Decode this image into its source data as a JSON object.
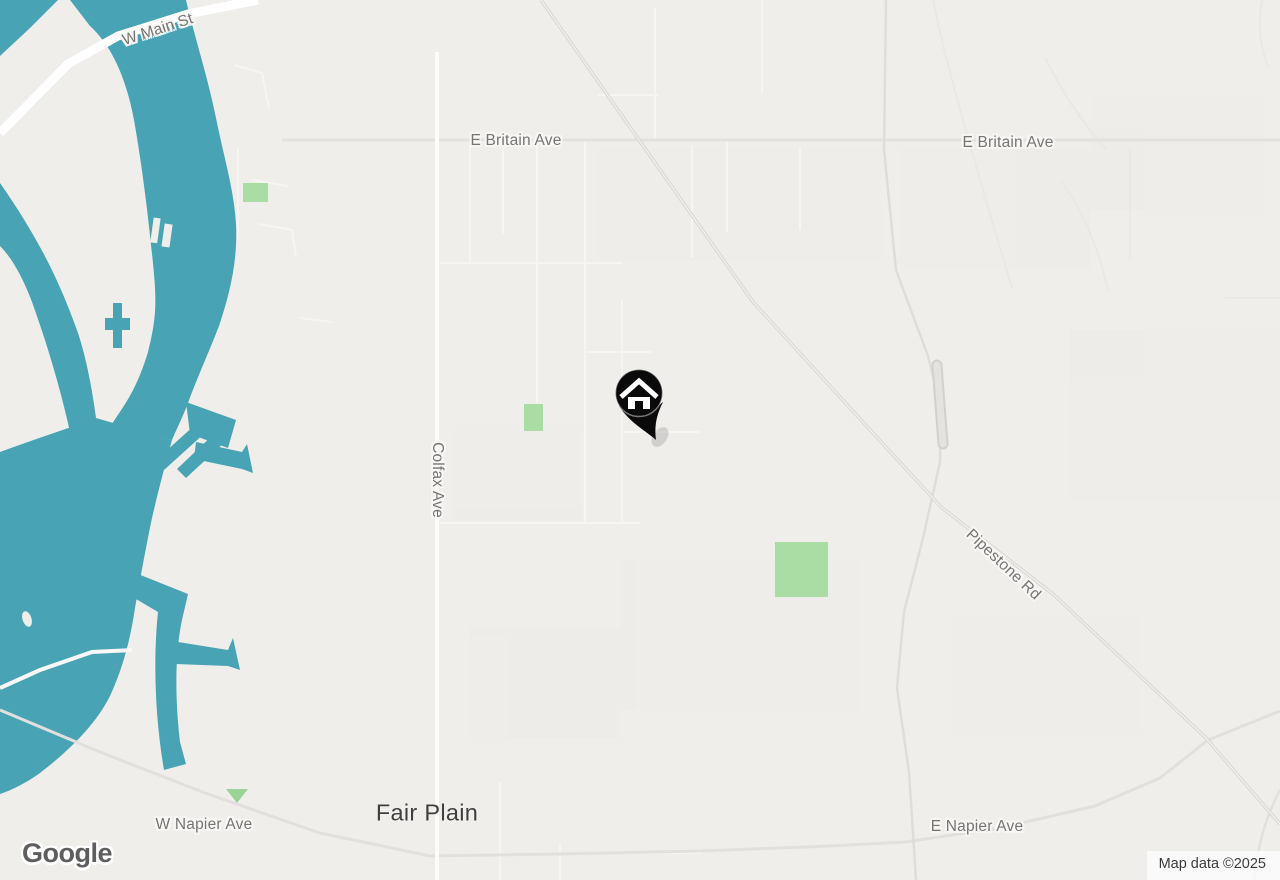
{
  "map": {
    "place_labels": {
      "fair_plain": "Fair Plain"
    },
    "street_labels": {
      "w_main_st": "W Main St",
      "e_britain_ave_west": "E Britain Ave",
      "e_britain_ave_east": "E Britain Ave",
      "colfax_ave": "Colfax Ave",
      "pipestone_rd": "Pipestone Rd",
      "w_napier_ave": "W Napier Ave",
      "e_napier_ave": "E Napier Ave"
    },
    "marker": {
      "type": "home-pin"
    },
    "attribution": {
      "logo": "Google",
      "copyright": "Map data ©2025"
    },
    "colors": {
      "water": "#48A4B5",
      "land": "#F0EEEB",
      "park_green": "#AADDA4",
      "street_label_gray": "#777572",
      "place_label_gray": "#413F3D",
      "marker_black": "#0A0A0A"
    }
  }
}
